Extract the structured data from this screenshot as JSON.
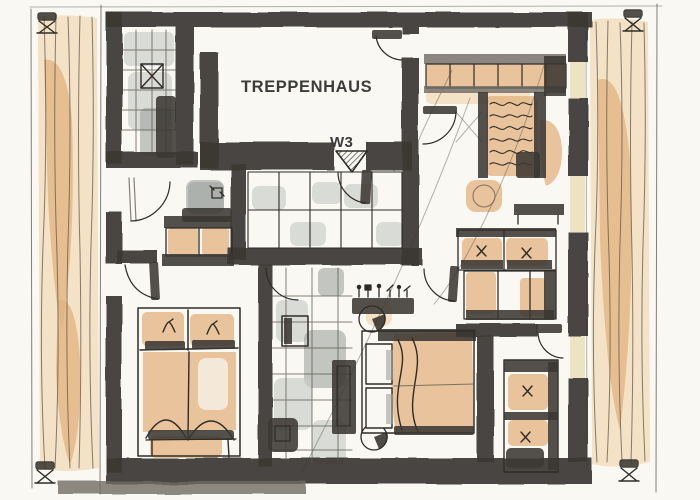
{
  "labels": {
    "staircase": "TREPPENHAUS",
    "unit": "W3"
  },
  "colors": {
    "paper": "#f9f8f3",
    "ink": "#2f2c28",
    "wall": "#3b3833",
    "wall_soft": "#6f6a63",
    "pencil": "#5c564e",
    "orange": "#e2b27e",
    "orange_soft": "#efd4a9",
    "tile": "#c8cbc8",
    "tile_dark": "#9ea3a0",
    "cream": "#ece4c0",
    "label": "#3c3c3c"
  }
}
